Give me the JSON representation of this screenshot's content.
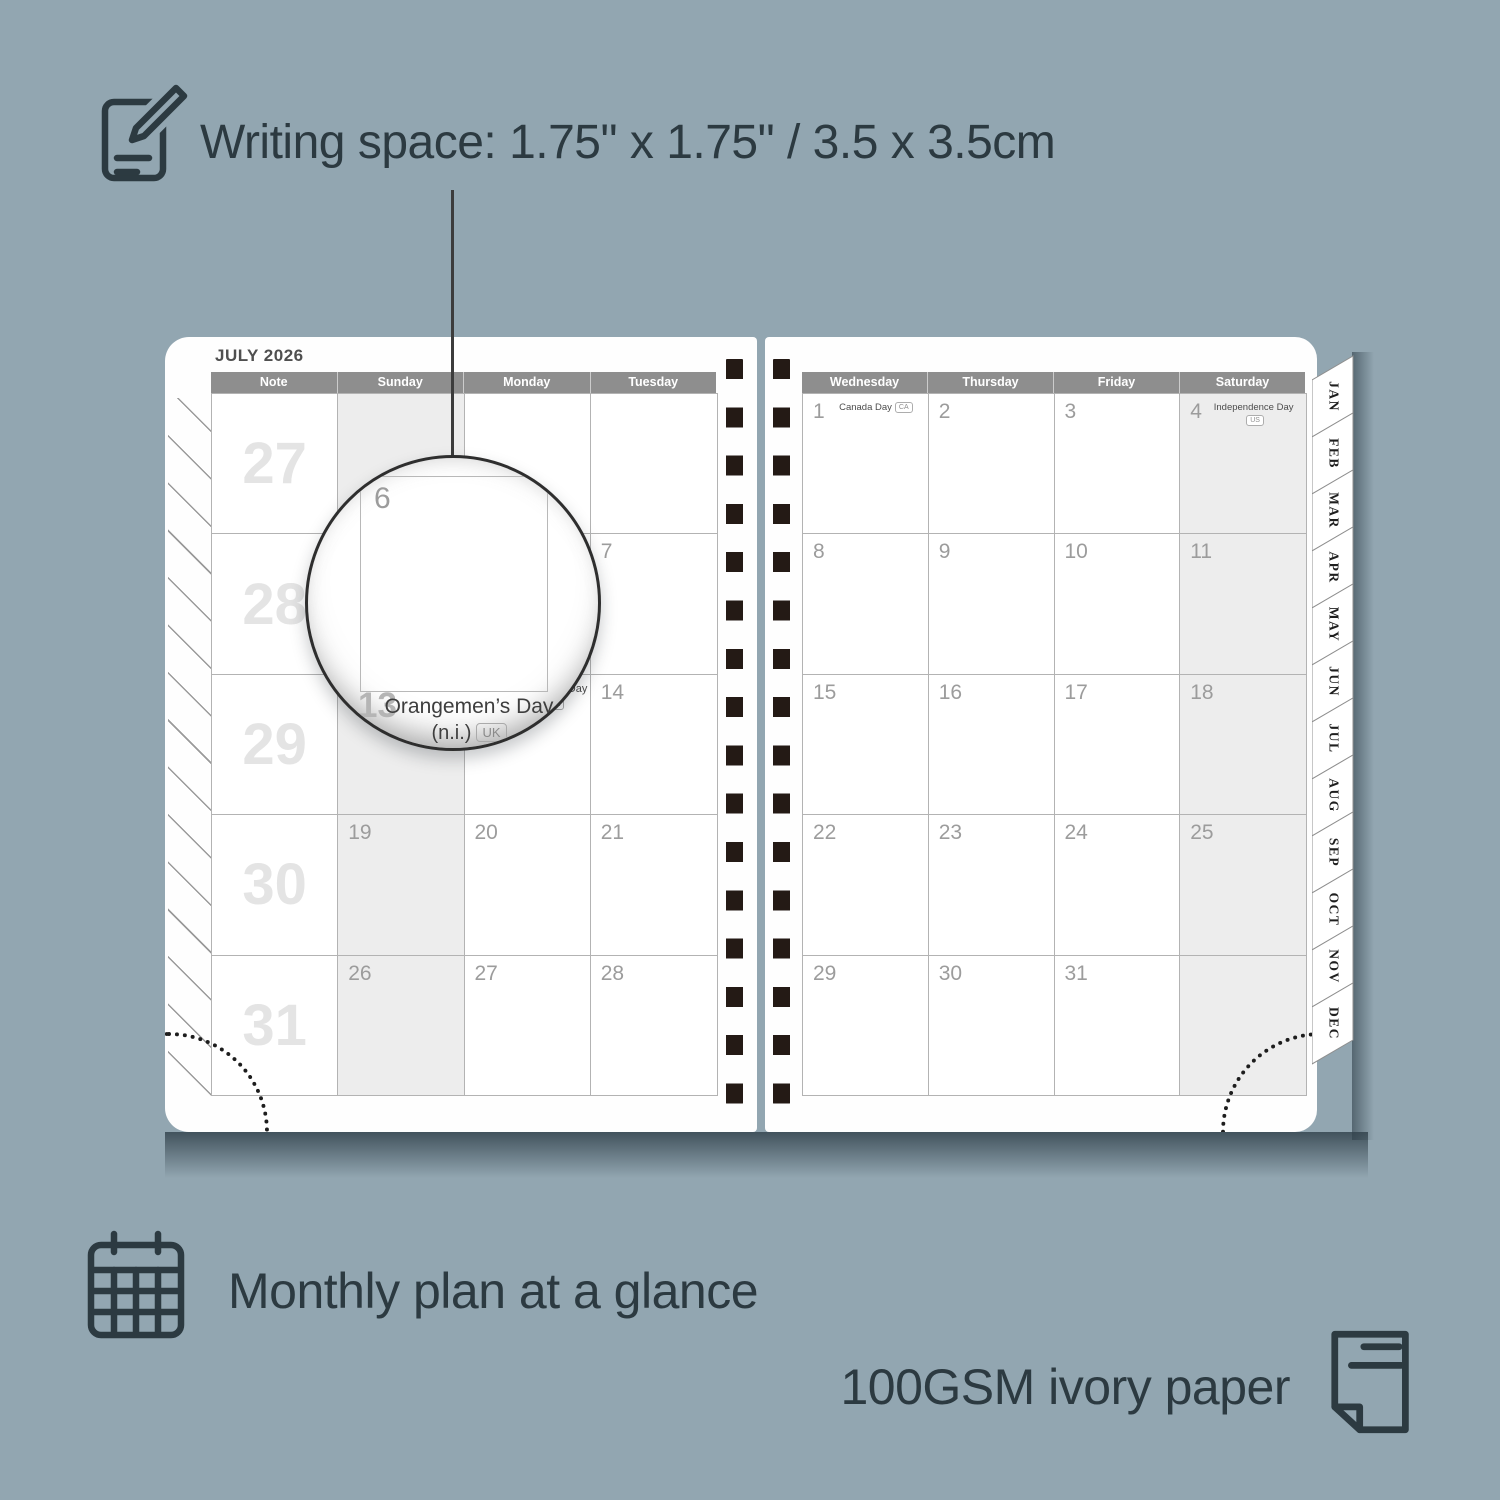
{
  "annotations": {
    "writing_space": "Writing space: 1.75\" x 1.75\" / 3.5 x 3.5cm",
    "monthly_plan": "Monthly plan at a glance",
    "paper": "100GSM ivory paper"
  },
  "planner": {
    "title": "JULY 2026",
    "left_headers": [
      "Note",
      "Sunday",
      "Monday",
      "Tuesday"
    ],
    "right_headers": [
      "Wednesday",
      "Thursday",
      "Friday",
      "Saturday"
    ],
    "week_numbers": [
      "27",
      "28",
      "29",
      "30",
      "31"
    ],
    "left_grid": [
      [
        "",
        "",
        ""
      ],
      [
        "",
        "",
        "7"
      ],
      [
        "",
        {
          "day": "13",
          "holiday": [
            "Orangemen’s Day",
            "(n.i.)"
          ],
          "badge": "UK"
        },
        "14"
      ],
      [
        "19",
        "20",
        "21"
      ],
      [
        "26",
        "27",
        "28"
      ]
    ],
    "right_grid": [
      [
        {
          "day": "1",
          "holiday": [
            "Canada Day"
          ],
          "badge": "CA"
        },
        "2",
        "3",
        {
          "day": "4",
          "holiday": [
            "Independence Day"
          ],
          "badge": "US"
        }
      ],
      [
        "8",
        "9",
        "10",
        "11"
      ],
      [
        "15",
        "16",
        "17",
        "18"
      ],
      [
        "22",
        "23",
        "24",
        "25"
      ],
      [
        "29",
        "30",
        "31",
        ""
      ]
    ],
    "tabs": [
      "JAN",
      "FEB",
      "MAR",
      "APR",
      "MAY",
      "JUN",
      "JUL",
      "AUG",
      "SEP",
      "OCT",
      "NOV",
      "DEC"
    ],
    "magnifier": {
      "day_top": "6",
      "day_bottom": "13",
      "holiday_line1": "Orangemen’s Day",
      "holiday_line2": "(n.i.)",
      "badge": "UK"
    }
  },
  "colors": {
    "background": "#92a6b1",
    "annotation_text": "#2c3a41",
    "header_gray": "#8e8e8e",
    "shaded_cell": "#ededed",
    "binding_dark": "#241a15",
    "date_gray": "#9c9c9c",
    "week_number_gray": "#e4e4e4"
  }
}
